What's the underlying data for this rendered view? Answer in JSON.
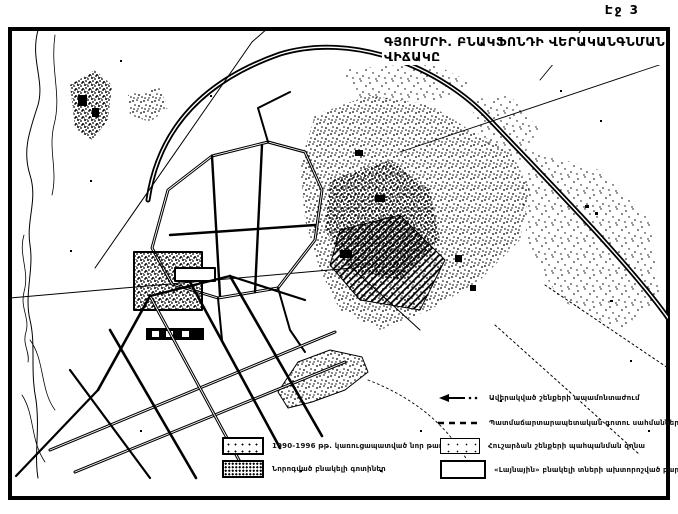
{
  "page_label": "Էջ 3",
  "title": {
    "line1": "ԳՅՈՒՄՐԻ. ԲՆԱԿՖՈՆԴԻ ՎԵՐԱԿԱՆԳՆՄԱՆ",
    "line2": "ՎԻՃԱԿԸ"
  },
  "legend": {
    "left_items": [
      {
        "swatch": "light-stipple-box",
        "label": "1990-1996 թթ. կառուցապատված նոր թաղամասեր"
      },
      {
        "swatch": "dense-stipple-box",
        "label": "Նորոգված բնակելի գոտիներ"
      }
    ],
    "right_items": [
      {
        "swatch": "arrow",
        "label": "Ավերակված շենքերի ապամոնտաժում"
      },
      {
        "swatch": "dashed-line",
        "label": "Պատմաճարտարապետական գոտու սահմանները"
      },
      {
        "swatch": "dotted-box",
        "label": "Հուշարձան շենքերի պահպանման զոնա"
      },
      {
        "swatch": "outline-box",
        "label": "«Լայնային» բնակելի տների ախտորոշված բարեկարգում"
      }
    ]
  },
  "colors": {
    "ink": "#000000",
    "paper": "#ffffff"
  }
}
